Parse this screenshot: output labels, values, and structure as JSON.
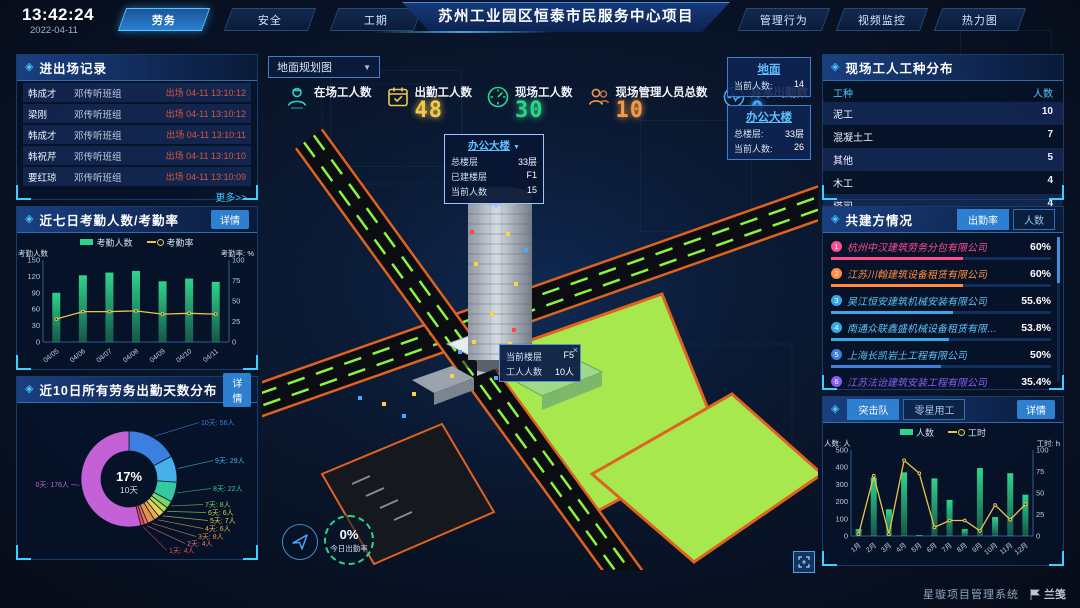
{
  "icons": {
    "panel_diamond": "◈",
    "dropdown_arrow": "▼",
    "close": "×"
  },
  "header": {
    "time": "13:42:24",
    "date": "2022-04-11",
    "nav_left": [
      {
        "label": "劳务",
        "active": true
      },
      {
        "label": "安全",
        "active": false
      },
      {
        "label": "工期",
        "active": false
      }
    ],
    "title": "苏州工业园区恒泰市民服务中心项目",
    "nav_right": [
      {
        "label": "管理行为"
      },
      {
        "label": "视频监控"
      },
      {
        "label": "热力图"
      }
    ]
  },
  "entry_exit": {
    "title": "进出场记录",
    "more_label": "更多>>",
    "rows": [
      {
        "name": "韩成才",
        "group": "邓传听班组",
        "event": "出场 04-11 13:10:12"
      },
      {
        "name": "梁刚",
        "group": "邓传听班组",
        "event": "出场 04-11 13:10:12"
      },
      {
        "name": "韩成才",
        "group": "邓传听班组",
        "event": "出场 04-11 13:10:11"
      },
      {
        "name": "韩祝芹",
        "group": "邓传听班组",
        "event": "出场 04-11 13:10:10"
      },
      {
        "name": "要红琼",
        "group": "邓传听班组",
        "event": "出场 04-11 13:10:09"
      }
    ]
  },
  "attendance_panel": {
    "title": "近七日考勤人数/考勤率",
    "detail_label": "详情"
  },
  "distribution_panel": {
    "title": "近10日所有劳务出勤天数分布",
    "detail_label": "详情"
  },
  "worker_types": {
    "title": "现场工人工种分布",
    "columns": [
      "工种",
      "人数"
    ],
    "rows": [
      [
        "泥工",
        "10"
      ],
      [
        "混凝土工",
        "7"
      ],
      [
        "其他",
        "5"
      ],
      [
        "木工",
        "4"
      ],
      [
        "塔司",
        "4"
      ]
    ]
  },
  "partners": {
    "title": "共建方情况",
    "tabs": [
      {
        "label": "出勤率",
        "active": true
      },
      {
        "label": "人数",
        "active": false
      }
    ],
    "rows": [
      {
        "rank": "1",
        "name": "杭州中汉建筑劳务分包有限公司",
        "value": "60%",
        "pct": 60,
        "color": "#ff4d8f"
      },
      {
        "rank": "2",
        "name": "江苏川翰建筑设备租赁有限公司",
        "value": "60%",
        "pct": 60,
        "color": "#ff8c3f"
      },
      {
        "rank": "3",
        "name": "吴江恒安建筑机械安装有限公司",
        "value": "55.6%",
        "pct": 55.6,
        "color": "#38a8e8"
      },
      {
        "rank": "4",
        "name": "南通众联鑫盛机械设备租赁有限公司",
        "value": "53.8%",
        "pct": 53.8,
        "color": "#38a8e8"
      },
      {
        "rank": "5",
        "name": "上海长凯岩土工程有限公司",
        "value": "50%",
        "pct": 50,
        "color": "#3f7fe0"
      },
      {
        "rank": "6",
        "name": "江苏法诒建筑安装工程有限公司",
        "value": "35.4%",
        "pct": 35.4,
        "color": "#8a5cf6"
      }
    ]
  },
  "team_panel": {
    "tabs": [
      {
        "label": "突击队",
        "active": true
      },
      {
        "label": "零星用工",
        "active": false
      }
    ],
    "detail_label": "详情"
  },
  "map": {
    "view_select": "地面规划图",
    "stats": [
      {
        "label": "在场工人数",
        "value": "",
        "icon": "worker-icon",
        "color": "#2fd4c8"
      },
      {
        "label": "出勤工人数",
        "value": "48",
        "icon": "calendar-icon",
        "color": "#f2c94c"
      },
      {
        "label": "现场工人数",
        "value": "30",
        "icon": "gauge-icon",
        "color": "#2fd48b"
      },
      {
        "label": "现场管理人员总数",
        "value": "10",
        "icon": "people-icon",
        "color": "#f2994a"
      },
      {
        "label": "异常出勤数",
        "value": "0",
        "icon": "pulse-icon",
        "color": "#3da9fc"
      }
    ],
    "building_tooltip": {
      "title": "办公大楼",
      "rows": [
        {
          "label": "总楼层",
          "value": "33层"
        },
        {
          "label": "已建楼层",
          "value": "F1"
        },
        {
          "label": "当前人数",
          "value": "15"
        }
      ]
    },
    "floor_tooltip": {
      "rows": [
        {
          "label": "当前楼层",
          "value": "F5"
        },
        {
          "label": "工人人数",
          "value": "10人"
        }
      ]
    },
    "float_panels": [
      {
        "title": "地面",
        "rows": [
          {
            "label": "当前人数:",
            "value": "14"
          }
        ]
      },
      {
        "title": "办公大楼",
        "rows": [
          {
            "label": "总楼层:",
            "value": "33层"
          },
          {
            "label": "当前人数:",
            "value": "26"
          }
        ]
      }
    ],
    "gauge": {
      "value": "0%",
      "label": "今日出勤率"
    }
  },
  "footer": {
    "system": "星璇项目管理系统",
    "logo": "兰笺"
  },
  "chart_data": [
    {
      "id": "attendance",
      "type": "bar+line",
      "title": "近七日考勤人数/考勤率",
      "categories": [
        "04/05",
        "04/06",
        "04/07",
        "04/08",
        "04/09",
        "04/10",
        "04/11"
      ],
      "series": [
        {
          "name": "考勤人数",
          "type": "bar",
          "color": "#2fd48b",
          "axis": "left",
          "values": [
            90,
            122,
            127,
            130,
            111,
            116,
            110
          ]
        },
        {
          "name": "考勤率",
          "type": "line",
          "color": "#e8c547",
          "axis": "right",
          "values": [
            28,
            37,
            37,
            38,
            34,
            35,
            34
          ]
        }
      ],
      "left_axis": {
        "label": "考勤人数",
        "min": 0,
        "max": 150,
        "ticks": [
          0,
          30,
          60,
          90,
          120,
          150
        ]
      },
      "right_axis": {
        "label": "考勤率: %",
        "min": 0,
        "max": 100,
        "ticks": [
          0,
          25,
          50,
          75,
          100
        ]
      },
      "legend_position": "top",
      "grid": false
    },
    {
      "id": "distribution",
      "type": "pie",
      "title": "近10日所有劳务出勤天数分布",
      "center_value": "17%",
      "center_label": "10天",
      "slices": [
        {
          "label": "10天",
          "count": "56人",
          "value": 56,
          "color": "#3b7fe0"
        },
        {
          "label": "9天",
          "count": "29人",
          "value": 29,
          "color": "#45b1e8"
        },
        {
          "label": "8天",
          "count": "22人",
          "value": 22,
          "color": "#35c9a0"
        },
        {
          "label": "7天",
          "count": "8人",
          "value": 8,
          "color": "#7ed36b"
        },
        {
          "label": "6天",
          "count": "6人",
          "value": 6,
          "color": "#b5d94f"
        },
        {
          "label": "5天",
          "count": "7人",
          "value": 7,
          "color": "#e3d34f"
        },
        {
          "label": "4天",
          "count": "6人",
          "value": 6,
          "color": "#e8b04a"
        },
        {
          "label": "3天",
          "count": "8人",
          "value": 8,
          "color": "#e88e4a"
        },
        {
          "label": "2天",
          "count": "4人",
          "value": 4,
          "color": "#e8766b"
        },
        {
          "label": "1天",
          "count": "4人",
          "value": 4,
          "color": "#e84a4a"
        },
        {
          "label": "0天",
          "count": "176人",
          "value": 176,
          "color": "#c561d6"
        }
      ]
    },
    {
      "id": "team",
      "type": "bar+line",
      "title": "突击队",
      "categories": [
        "1月",
        "2月",
        "3月",
        "4月",
        "5月",
        "6月",
        "7月",
        "8月",
        "9月",
        "10月",
        "11月",
        "12月"
      ],
      "series": [
        {
          "name": "人数",
          "type": "bar",
          "color": "#2fd48b",
          "axis": "left",
          "values": [
            40,
            340,
            155,
            370,
            5,
            335,
            210,
            40,
            395,
            110,
            365,
            240
          ]
        },
        {
          "name": "工时",
          "type": "line",
          "color": "#e8c547",
          "axis": "right",
          "values": [
            2,
            70,
            2,
            88,
            73,
            10,
            18,
            18,
            6,
            36,
            19,
            37
          ]
        }
      ],
      "left_axis": {
        "label": "人数: 人",
        "min": 0,
        "max": 500,
        "ticks": [
          0,
          100,
          200,
          300,
          400,
          500
        ]
      },
      "right_axis": {
        "label": "工时: h",
        "min": 0,
        "max": 100,
        "ticks": [
          0,
          25,
          50,
          75,
          100
        ]
      },
      "legend_position": "top",
      "grid": false
    }
  ]
}
